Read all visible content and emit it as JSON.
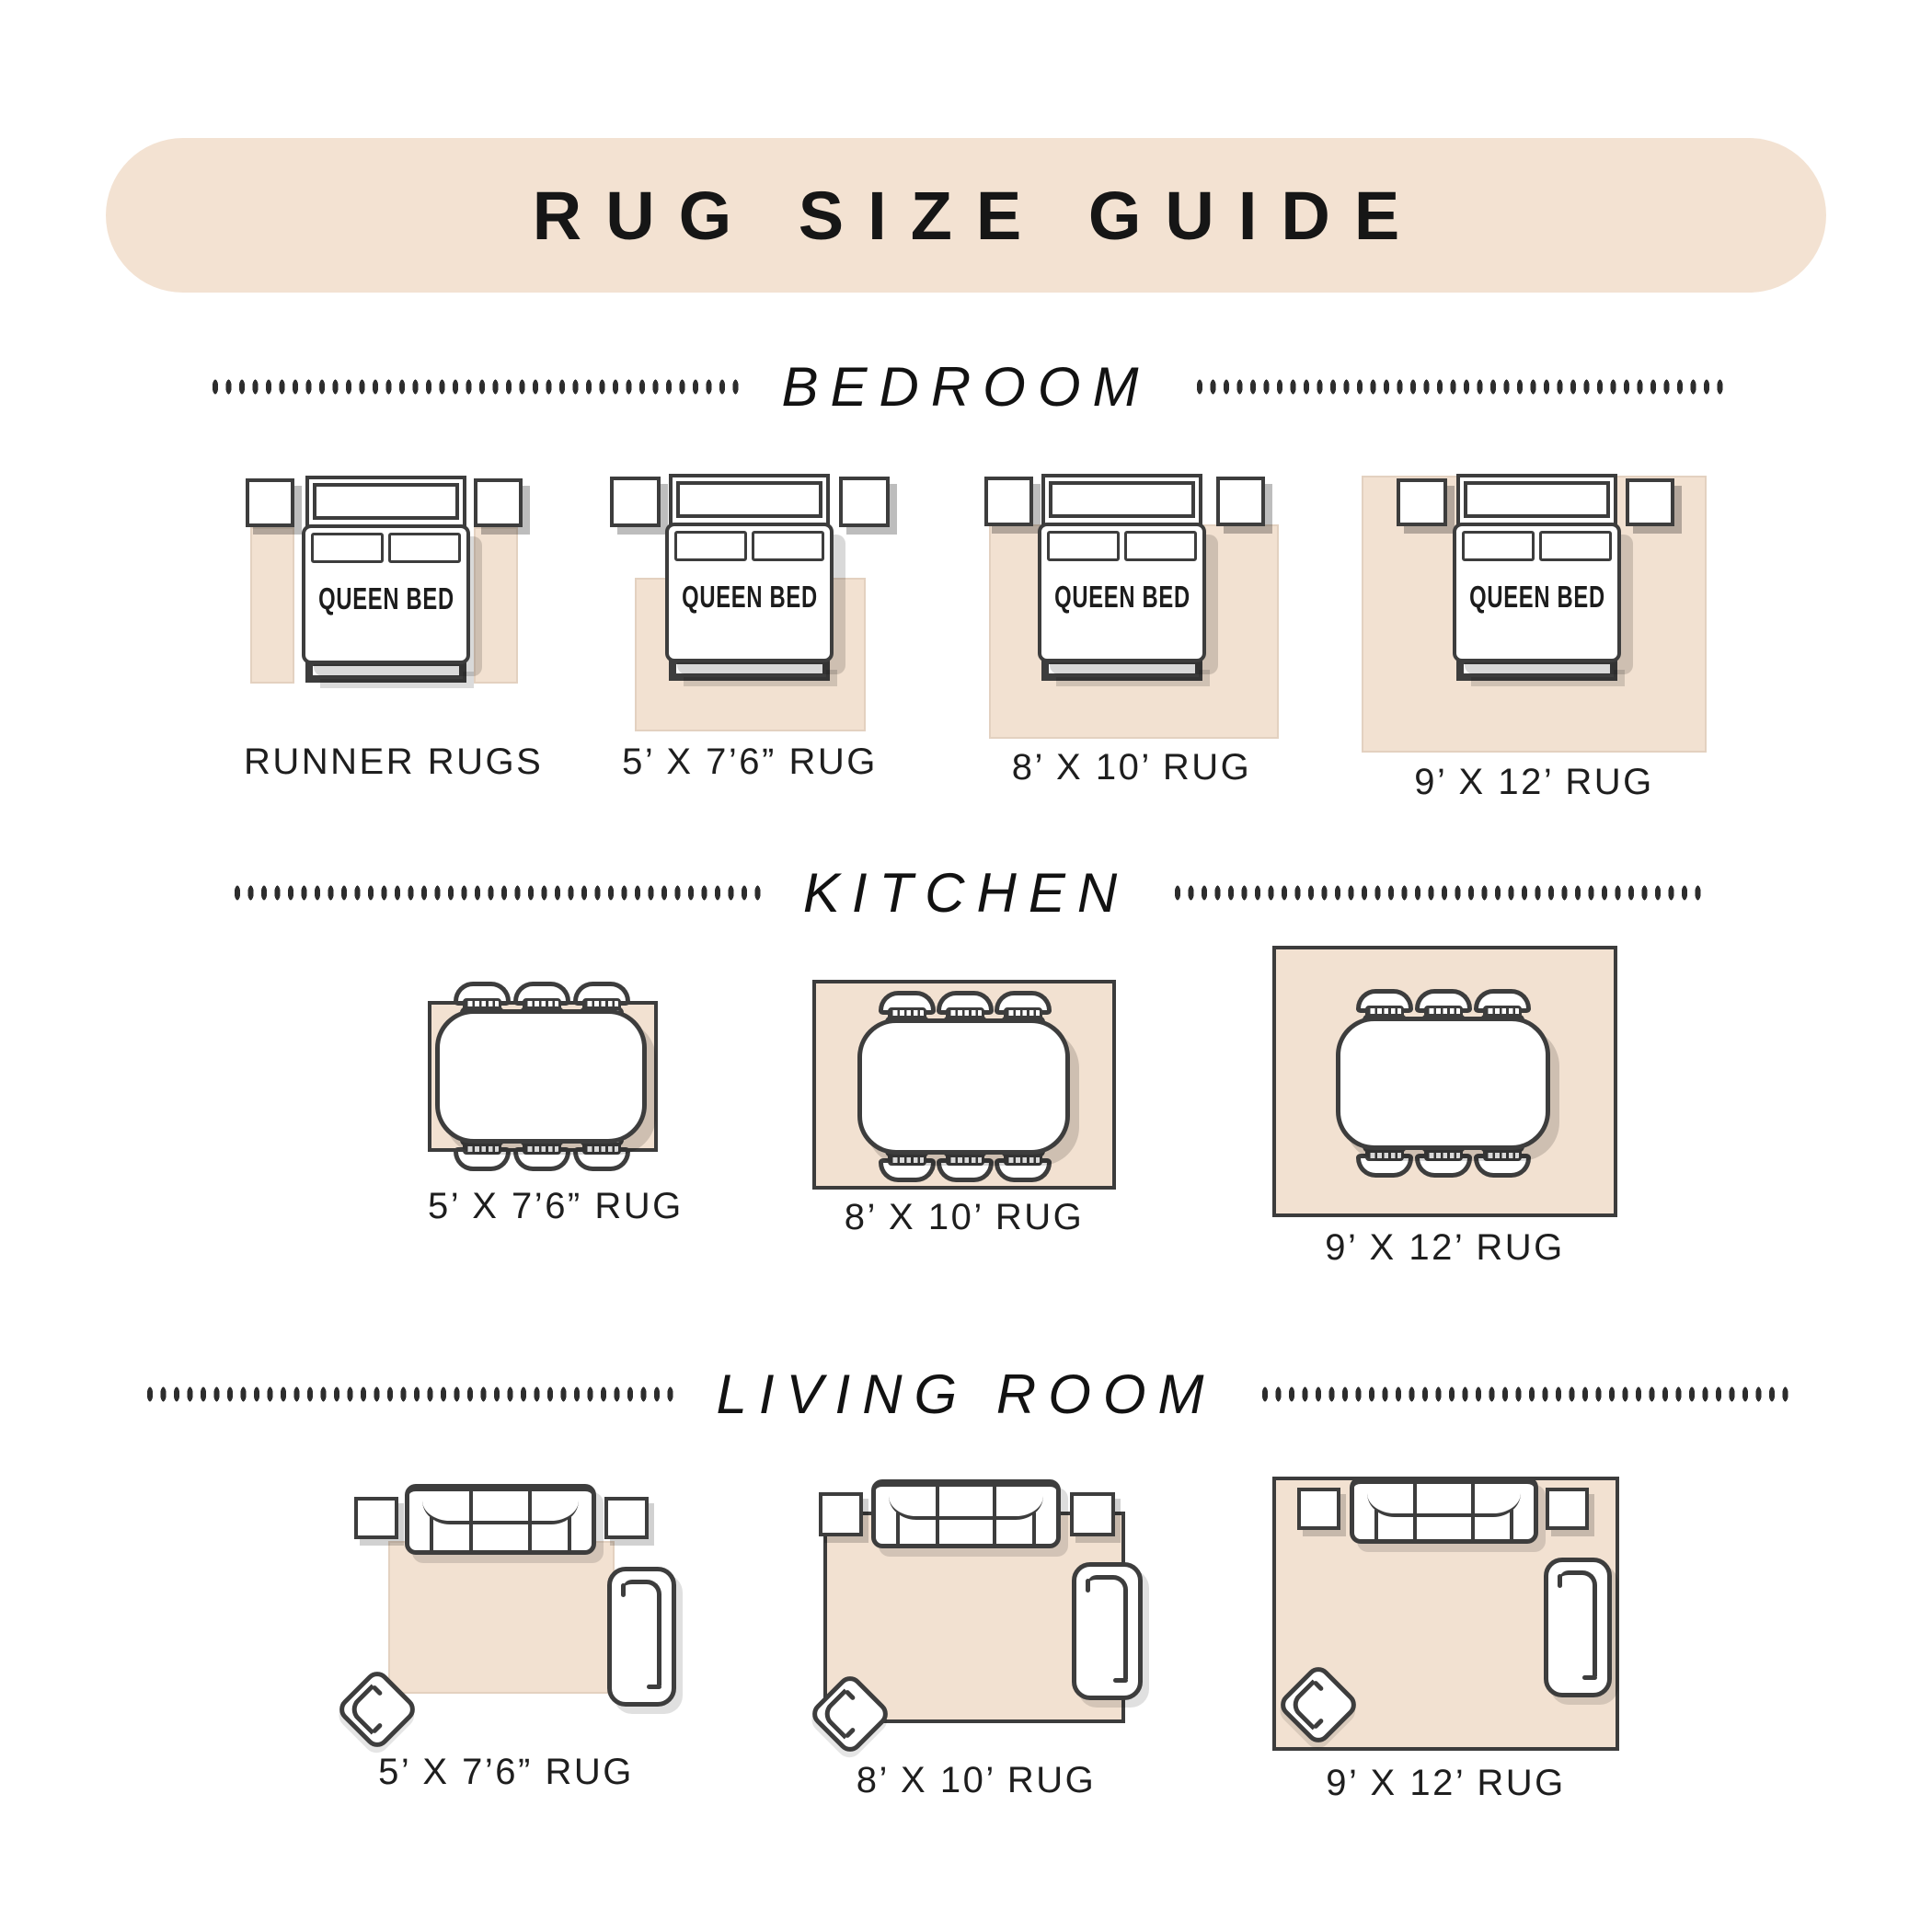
{
  "title": "RUG SIZE GUIDE",
  "bed_label": "QUEEN BED",
  "colors": {
    "beige": "#f2e1d1",
    "banner": "#f3e2d2",
    "outline": "#3d3d3d",
    "text": "#1e1e1e"
  },
  "sections": [
    {
      "name": "BEDROOM",
      "diagrams": [
        {
          "label": "RUNNER RUGS"
        },
        {
          "label": "5’ X 7’6” RUG"
        },
        {
          "label": "8’ X 10’ RUG"
        },
        {
          "label": "9’ X 12’ RUG"
        }
      ]
    },
    {
      "name": "KITCHEN",
      "diagrams": [
        {
          "label": "5’ X 7’6” RUG"
        },
        {
          "label": "8’ X 10’ RUG"
        },
        {
          "label": "9’ X 12’ RUG"
        }
      ]
    },
    {
      "name": "LIVING ROOM",
      "diagrams": [
        {
          "label": "5’ X 7’6” RUG"
        },
        {
          "label": "8’ X 10’ RUG"
        },
        {
          "label": "9’ X 12’ RUG"
        }
      ]
    }
  ]
}
